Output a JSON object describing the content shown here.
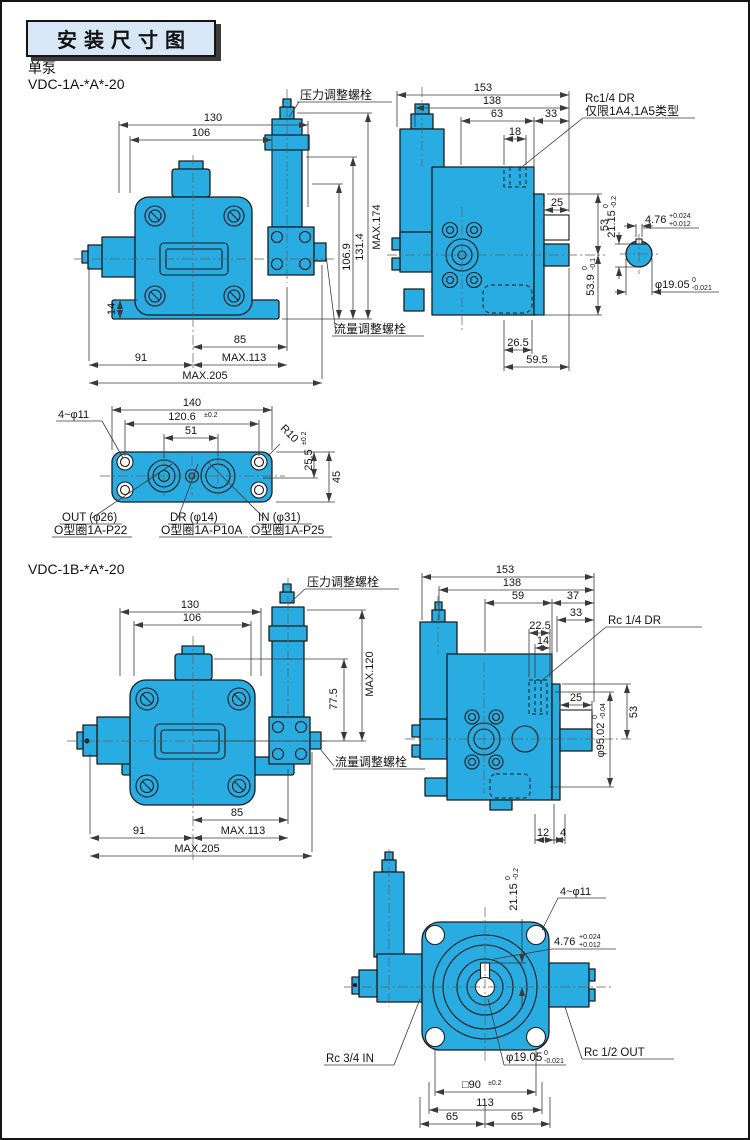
{
  "page": {
    "title": "安装尺寸图",
    "pump_type": "单泵",
    "model_a": "VDC-1A-*A*-20",
    "model_b": "VDC-1B-*A*-20"
  },
  "labels": {
    "pressure_bolt": "压力调整螺栓",
    "flow_bolt": "流量调整螺栓"
  },
  "colors": {
    "pump_fill": "#29ace2",
    "title_bg": "#d8e7f6",
    "line": "#1c1c1c"
  },
  "view_1a_front": {
    "dim_130": "130",
    "dim_106": "106",
    "dim_max174": "MAX.174",
    "dim_131_4": "131.4",
    "dim_106_9": "106.9",
    "dim_14": "14",
    "dim_85": "85",
    "dim_max113": "MAX.113",
    "dim_91": "91",
    "dim_max205": "MAX.205"
  },
  "view_1a_side": {
    "dim_153": "153",
    "dim_138": "138",
    "dim_63": "63",
    "dim_33": "33",
    "dim_18": "18",
    "port_note_line1": "Rc1/4  DR",
    "port_note_line2": "仅限1A4,1A5类型",
    "dim_25": "25",
    "dim_53": "53",
    "dim_53_9": "53.9",
    "tol_53_9_top": "0",
    "tol_53_9_bot": "-0.1",
    "dim_26_5": "26.5",
    "dim_59_5": "59.5"
  },
  "shaft_detail_1a": {
    "dim_21_15": "21.15",
    "tol_21_15_top": "0",
    "tol_21_15_bot": "-0.2",
    "dim_4_76": "4.76",
    "tol_4_76_top": "+0.024",
    "tol_4_76_bot": "+0.012",
    "dim_19_05": "φ19.05",
    "tol_19_05_top": "0",
    "tol_19_05_bot": "-0.021"
  },
  "view_1a_bottom": {
    "dim_140": "140",
    "dim_120_6": "120.6",
    "tol_120_6": "±0.2",
    "dim_51": "51",
    "holes_note": "4~φ11",
    "corner_radius": "R10",
    "dim_25_5": "25.5",
    "tol_25_5": "±0.2",
    "dim_45": "45",
    "port_out_line1": "OUT (φ26)",
    "port_out_line2": "O型圈1A-P22",
    "port_dr_line1": "DR (φ14)",
    "port_dr_line2": "O型圈1A-P10A",
    "port_in_line1": "IN (φ31)",
    "port_in_line2": "O型圈1A-P25"
  },
  "view_1b_front": {
    "dim_130": "130",
    "dim_106": "106",
    "dim_max120": "MAX.120",
    "dim_77_5": "77.5",
    "dim_85": "85",
    "dim_max113": "MAX.113",
    "dim_91": "91",
    "dim_max205": "MAX.205"
  },
  "view_1b_side": {
    "dim_153": "153",
    "dim_138": "138",
    "dim_59": "59",
    "dim_37": "37",
    "dim_33": "33",
    "dim_22_5": "22.5",
    "dim_14": "14",
    "port_note": "Rc  1/4 DR",
    "dim_25": "25",
    "dim_53": "53",
    "dim_95_02": "φ95.02",
    "tol_95_02_top": "0",
    "tol_95_02_bot": "-0.04",
    "dim_12": "12",
    "dim_4": "4"
  },
  "view_1b_rear": {
    "dim_21_15": "21.15",
    "tol_21_15_top": "0",
    "tol_21_15_bot": "-0.2",
    "holes_note": "4~φ11",
    "dim_4_76": "4.76",
    "tol_4_76_top": "+0.024",
    "tol_4_76_bot": "+0.012",
    "port_in": "Rc 3/4 IN",
    "port_out": "Rc  1/2 OUT",
    "dim_19_05": "φ19.05",
    "tol_19_05_top": "0",
    "tol_19_05_bot": "-0.021",
    "dim_sq90": "□90",
    "tol_sq90": "±0.2",
    "dim_113": "113",
    "dim_65_left": "65",
    "dim_65_right": "65"
  }
}
